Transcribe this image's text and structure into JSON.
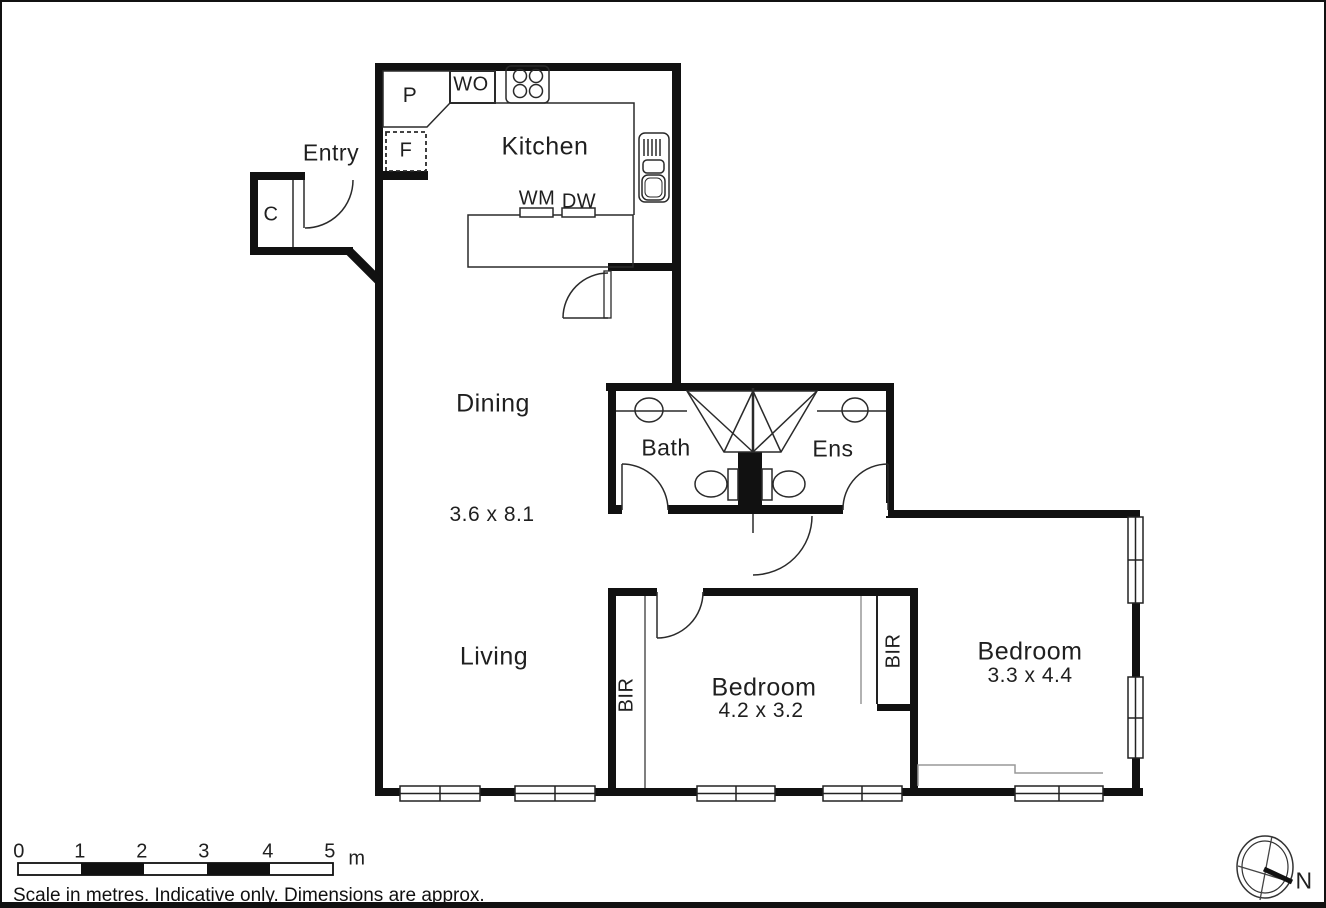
{
  "rooms": {
    "entry": "Entry",
    "kitchen": "Kitchen",
    "dining": "Dining",
    "dining_dims": "3.6 x 8.1",
    "living": "Living",
    "bath": "Bath",
    "ensuite": "Ens",
    "bedroom_mid": "Bedroom",
    "bedroom_mid_dims": "4.2 x 3.2",
    "bedroom_right": "Bedroom",
    "bedroom_right_dims": "3.3 x 4.4",
    "robe_left": "BIR",
    "robe_right": "BIR"
  },
  "fixtures": {
    "pantry": "P",
    "fridge": "F",
    "wall_oven": "WO",
    "cupboard": "C",
    "washing_machine": "WM",
    "dishwasher": "DW"
  },
  "scale_bar": {
    "ticks": [
      "0",
      "1",
      "2",
      "3",
      "4",
      "5"
    ],
    "unit": "m",
    "caption": "Scale in metres. Indicative only. Dimensions are approx."
  },
  "compass": {
    "north_label": "N"
  },
  "colors": {
    "wall": "#111111",
    "line": "#2a2a2a",
    "gray_line": "#999999",
    "background": "#ffffff"
  }
}
